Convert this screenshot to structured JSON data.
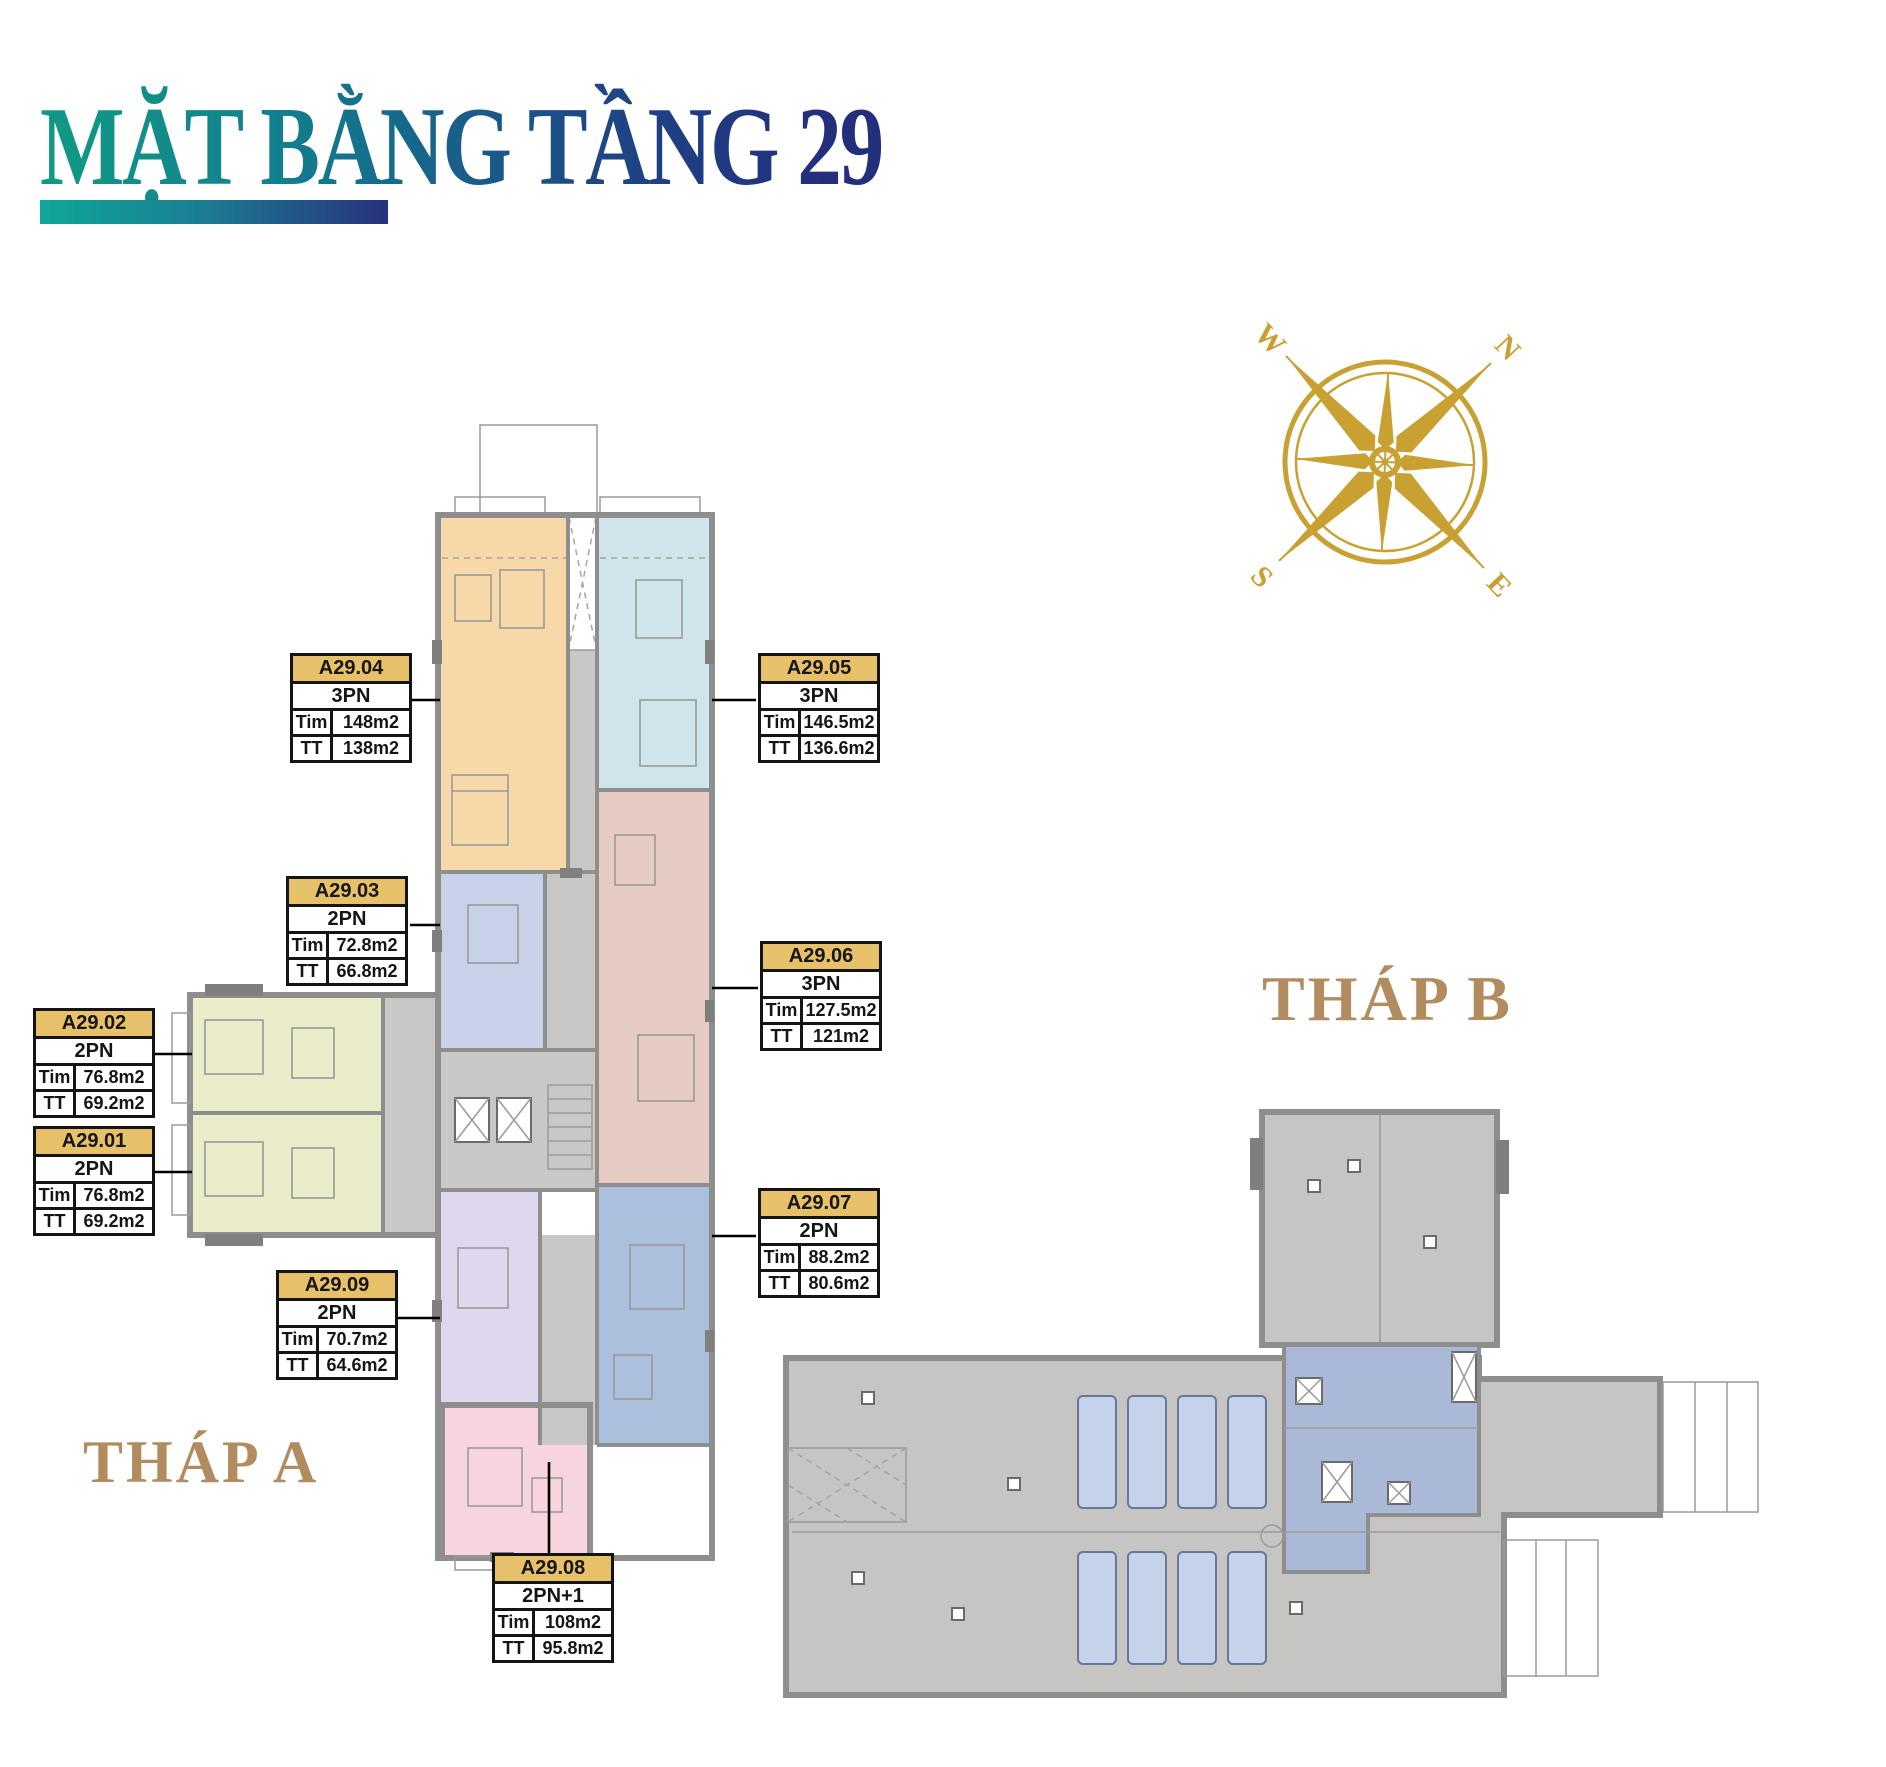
{
  "page": {
    "title": "MẶT BẰNG TẦNG 29"
  },
  "towers": {
    "a_label": "THÁP A",
    "b_label": "THÁP B"
  },
  "compass": {
    "n": "N",
    "e": "E",
    "s": "S",
    "w": "W"
  },
  "field_labels": {
    "tim": "Tim",
    "tt": "TT"
  },
  "units": [
    {
      "id": "A29.01",
      "type": "2PN",
      "tim": "76.8m2",
      "tt": "69.2m2"
    },
    {
      "id": "A29.02",
      "type": "2PN",
      "tim": "76.8m2",
      "tt": "69.2m2"
    },
    {
      "id": "A29.03",
      "type": "2PN",
      "tim": "72.8m2",
      "tt": "66.8m2"
    },
    {
      "id": "A29.04",
      "type": "3PN",
      "tim": "148m2",
      "tt": "138m2"
    },
    {
      "id": "A29.05",
      "type": "3PN",
      "tim": "146.5m2",
      "tt": "136.6m2"
    },
    {
      "id": "A29.06",
      "type": "3PN",
      "tim": "127.5m2",
      "tt": "121m2"
    },
    {
      "id": "A29.07",
      "type": "2PN",
      "tim": "88.2m2",
      "tt": "80.6m2"
    },
    {
      "id": "A29.08",
      "type": "2PN+1",
      "tim": "108m2",
      "tt": "95.8m2"
    },
    {
      "id": "A29.09",
      "type": "2PN",
      "tim": "70.7m2",
      "tt": "64.6m2"
    }
  ],
  "colors": {
    "gold": "#e7c169",
    "tan": "#b28c5f",
    "compass-gold": "#c9a032",
    "title-teal": "#119a84",
    "title-navy": "#232e7d",
    "unit-orange": "#f7d9a9",
    "unit-skyblue": "#cfe5eb",
    "unit-periwinkle": "#c8d1e8",
    "unit-rose": "#e5cbc2",
    "unit-olive": "#ebecca",
    "unit-steel": "#abc0dc",
    "unit-purple": "#ded7ee",
    "unit-pink": "#f8d4de",
    "towerb-blue": "#aab9d8"
  }
}
